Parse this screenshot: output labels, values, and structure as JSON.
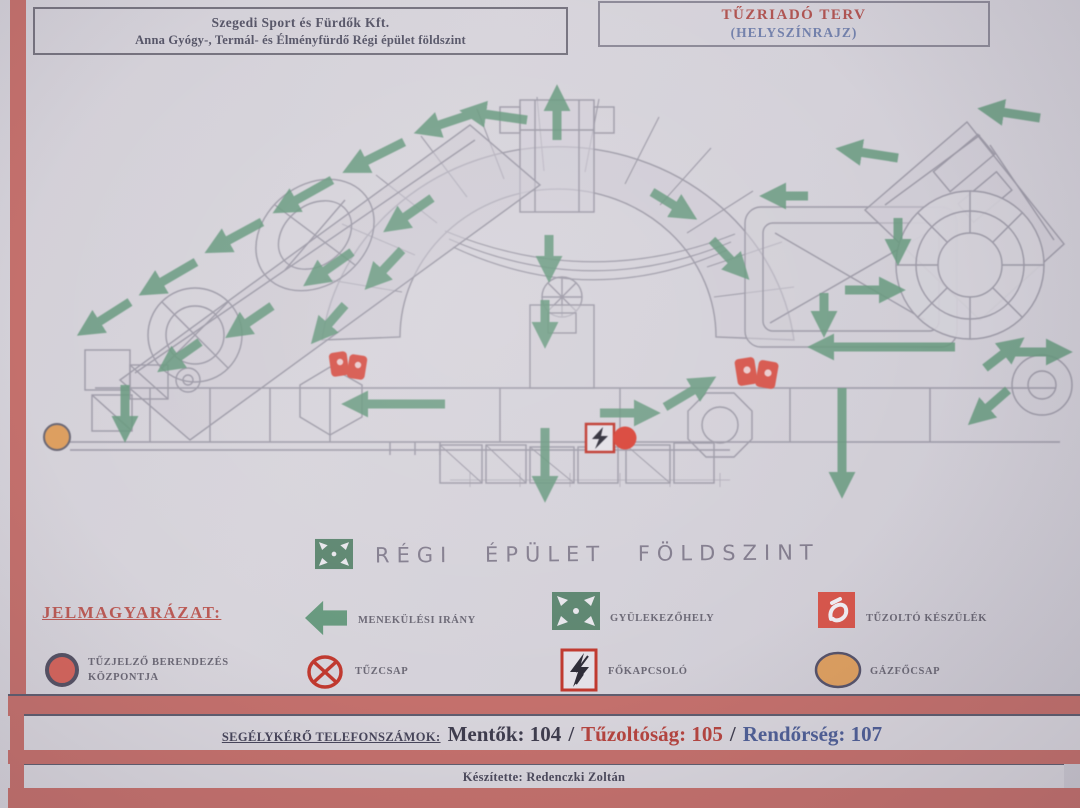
{
  "header": {
    "company_box": {
      "line1": "Szegedi Sport és Fürdők Kft.",
      "line2": "Anna Gyógy-, Termál- és Élményfürdő Régi épület földszint"
    },
    "plan_box": {
      "title": "TŰZRIADÓ TERV",
      "subtitle": "(HELYSZÍNRAJZ)"
    }
  },
  "plan": {
    "floor_label": "RÉGI ÉPÜLET FÖLDSZINT",
    "marker_icons": [
      "fire-extinguisher-marker-left",
      "fire-extinguisher-marker-right",
      "main-switch-marker",
      "fire-alarm-center-marker",
      "gas-valve-marker",
      "escape-route-arrows"
    ]
  },
  "legend": {
    "title": "JELMAGYARÁZAT:",
    "items": [
      {
        "icon": "escape-direction-arrow-icon",
        "label": "MENEKÜLÉSI IRÁNY"
      },
      {
        "icon": "assembly-point-icon",
        "label": "GYÜLEKEZŐHELY"
      },
      {
        "icon": "fire-extinguisher-icon",
        "label": "TŰZOLTÓ KÉSZÜLÉK"
      },
      {
        "icon": "fire-alarm-center-icon",
        "label": "TŰZJELZŐ BERENDEZÉS KÖZPONTJA"
      },
      {
        "icon": "fire-hydrant-icon",
        "label": "TŰZCSAP"
      },
      {
        "icon": "main-switch-icon",
        "label": "FŐKAPCSOLÓ"
      },
      {
        "icon": "gas-main-valve-icon",
        "label": "GÁZFŐCSAP"
      }
    ]
  },
  "footer": {
    "emergency_label": "SEGÉLYKÉRŐ TELEFONSZÁMOK:",
    "ambulance": "Mentők: 104",
    "slash": "/",
    "fire": "Tűzoltóság: 105",
    "police": "Rendőrség: 107",
    "credit": "Készítette: Redenczki Zoltán"
  },
  "colors": {
    "page_border_band": "#c4706c",
    "arrow_green": "#67997e",
    "title_red": "#b05552",
    "title_blue": "#7381ac",
    "legend_red": "#bb5a55",
    "marker_red": "#d6564c",
    "marker_orange": "#dd9f60",
    "phone_fire_red": "#b5443f",
    "phone_police_blue": "#4f5f96"
  }
}
